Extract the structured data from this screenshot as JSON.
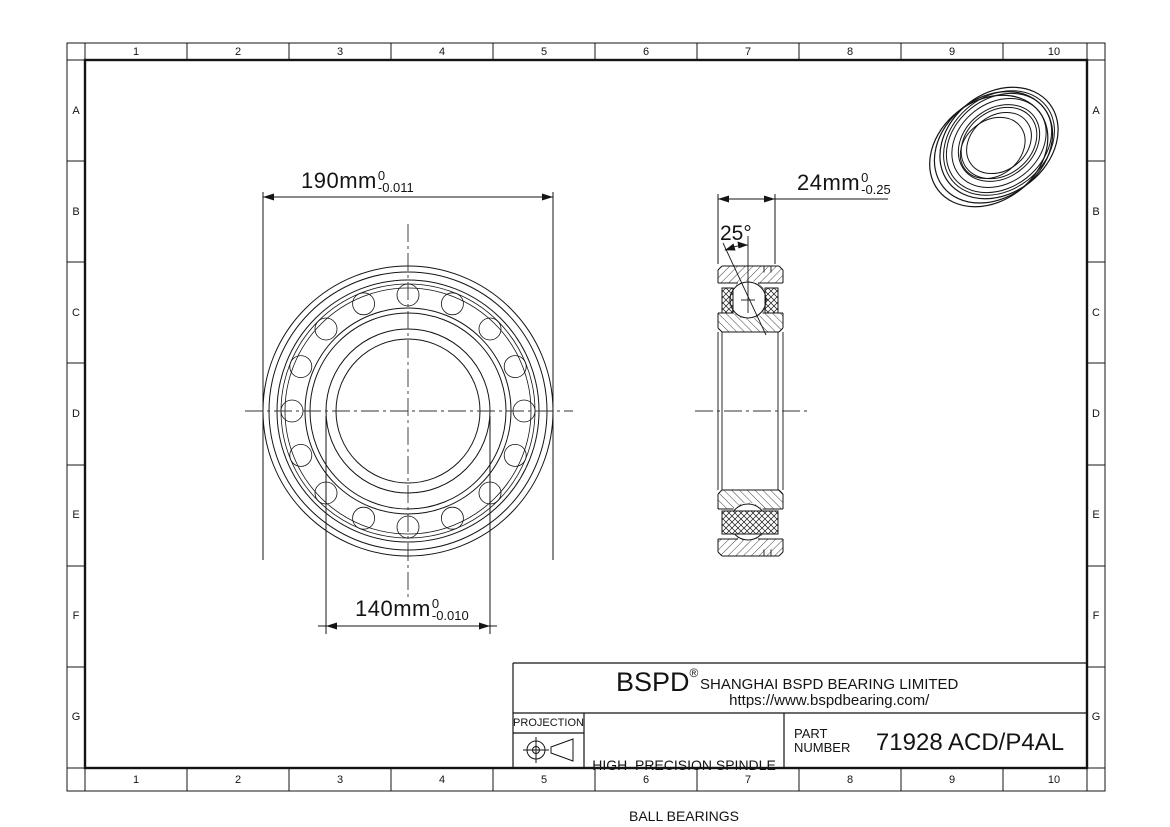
{
  "colors": {
    "ink": "#141414",
    "background": "#ffffff"
  },
  "rulers": {
    "columns": [
      "1",
      "2",
      "3",
      "4",
      "5",
      "6",
      "7",
      "8",
      "9",
      "10"
    ],
    "rows": [
      "A",
      "B",
      "C",
      "D",
      "E",
      "F",
      "G"
    ]
  },
  "dimensions": {
    "outer_diameter": {
      "value": "190mm",
      "tol_upper": "0",
      "tol_lower": "-0.011"
    },
    "bore_diameter": {
      "value": "140mm",
      "tol_upper": "0",
      "tol_lower": "-0.010"
    },
    "width": {
      "value": "24mm",
      "tol_upper": "0",
      "tol_lower": "-0.25"
    },
    "contact_angle": {
      "value": "25°"
    }
  },
  "title_block": {
    "logo": "BSPD",
    "registered": "®",
    "company": "SHANGHAI BSPD BEARING LIMITED",
    "website": "https://www.bspdbearing.com/",
    "projection_label": "PROJECTION",
    "product_line1": "HIGH  PRECISION SPINDLE",
    "product_line2": "BALL BEARINGS",
    "part_label1": "PART",
    "part_label2": "NUMBER",
    "part_number": "71928 ACD/P4AL"
  }
}
